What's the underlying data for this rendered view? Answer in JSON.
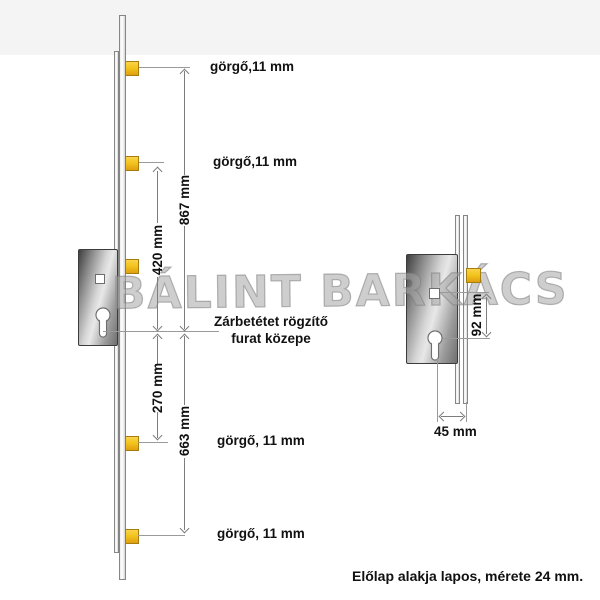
{
  "watermark": "BÁLINT BARKÁCS",
  "left_view": {
    "roller_labels": [
      "görgő,11 mm",
      "görgő,11 mm",
      "görgő, 11 mm",
      "görgő, 11 mm"
    ],
    "dims": {
      "outer_top": "867 mm",
      "inner_top": "420 mm",
      "inner_bottom": "270 mm",
      "outer_bottom": "663 mm"
    },
    "ref_note_line1": "Zárbetétet rögzítő",
    "ref_note_line2": "furat közepe"
  },
  "right_view": {
    "dims": {
      "follower_to_cylinder": "92 mm",
      "backset": "45 mm"
    }
  },
  "footer_note": "Előlap alakja lapos, mérete 24 mm.",
  "colors": {
    "roller_yellow": "#f3c41d",
    "metal_dark": "#3f3f3f",
    "metal_light": "#e8e8e8",
    "line_gray": "#9a9a9a",
    "text": "#111111"
  }
}
